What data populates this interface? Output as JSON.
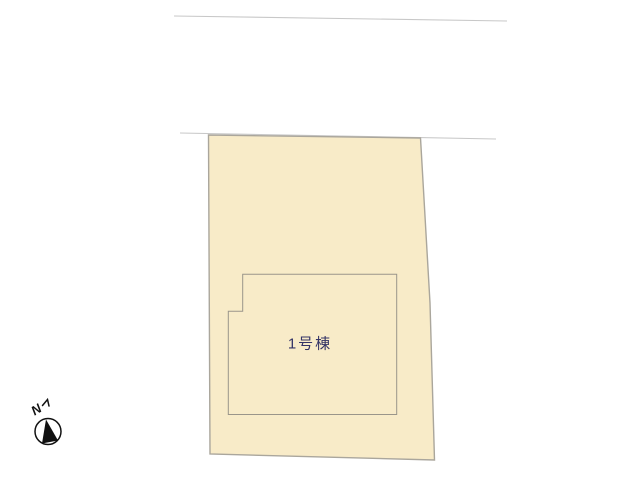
{
  "plan": {
    "building": {
      "label": "1号棟"
    },
    "compass": {
      "north_label": "N"
    },
    "colors": {
      "background": "#ffffff",
      "road_line": "#c8c8c8",
      "parcel_fill": "#f8ebc8",
      "parcel_stroke": "#aaa69c",
      "building_stroke": "#9a958a",
      "building_label": "#333366",
      "compass_ink": "#111111"
    },
    "geometry": {
      "road_line_upper": "174,16 507,21",
      "road_line_lower": "180,133 496,139",
      "parcel": "208.5,135 420.5,138 430,303 434.5,460 210,454",
      "building": "242.7,274.3 396.7,274.3 396.7,414.5 228.3,414.5 228.3,311.3 242.7,311.3",
      "compass_needle": "46,419.5 42,443.5 58,440.5"
    }
  }
}
